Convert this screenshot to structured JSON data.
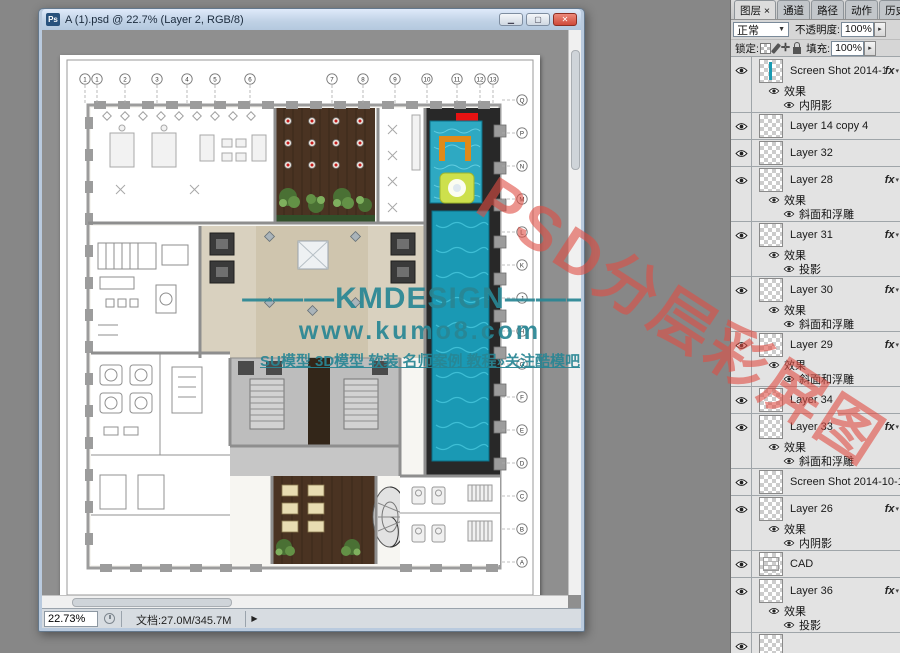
{
  "document_window": {
    "title": "A (1).psd @ 22.7% (Layer 2, RGB/8)",
    "zoom_field": "22.73%",
    "doc_info": "文档:27.0M/345.7M"
  },
  "watermark": {
    "brand": "———KMDESIGN———",
    "url": "www.kumo8.com",
    "tagline": "SU模型 3D模型 软装 名师案例 教程»关注酷模吧",
    "stamp": "PSD分层彩屏图",
    "teal_color": "#288694",
    "red_color": "#e04c42"
  },
  "plan": {
    "grid_top": [
      "1",
      "1",
      "2",
      "3",
      "4",
      "5",
      "6",
      "7",
      "8",
      "9",
      "10",
      "11",
      "12",
      "13"
    ],
    "grid_right": [
      "Q",
      "P",
      "N",
      "M",
      "L",
      "K",
      "J",
      "H",
      "G",
      "F",
      "E",
      "D",
      "C",
      "B",
      "A"
    ]
  },
  "panel": {
    "tabs": [
      {
        "label": "图层 ×"
      },
      {
        "label": "通道"
      },
      {
        "label": "路径"
      },
      {
        "label": "动作"
      },
      {
        "label": "历史记录"
      }
    ],
    "blend_mode": "正常",
    "opacity_label": "不透明度:",
    "opacity_value": "100%",
    "lock_label": "锁定:",
    "fill_label": "填充:",
    "fill_value": "100%",
    "effects_label": "效果",
    "layers": [
      {
        "name": "Screen Shot 2014-10-16 at ...",
        "fx": true,
        "thumb": "screenshot",
        "effects": [
          "内阴影"
        ]
      },
      {
        "name": "Layer 14 copy 4",
        "fx": false
      },
      {
        "name": "Layer 32",
        "fx": false
      },
      {
        "name": "Layer 28",
        "fx": true,
        "effects": [
          "斜面和浮雕"
        ]
      },
      {
        "name": "Layer 31",
        "fx": true,
        "effects": [
          "投影"
        ]
      },
      {
        "name": "Layer 30",
        "fx": true,
        "effects": [
          "斜面和浮雕"
        ]
      },
      {
        "name": "Layer 29",
        "fx": true,
        "effects": [
          "斜面和浮雕"
        ]
      },
      {
        "name": "Layer 34",
        "fx": false
      },
      {
        "name": "Layer 33",
        "fx": true,
        "effects": [
          "斜面和浮雕"
        ]
      },
      {
        "name": "Screen Shot 2014-10-16 at 4.5...",
        "fx": false
      },
      {
        "name": "Layer 26",
        "fx": true,
        "effects": [
          "内阴影"
        ]
      },
      {
        "name": "CAD",
        "fx": false,
        "thumb": "cad"
      },
      {
        "name": "Layer 36",
        "fx": true,
        "effects": [
          "投影"
        ]
      },
      {
        "name": "",
        "fx": false
      }
    ]
  }
}
